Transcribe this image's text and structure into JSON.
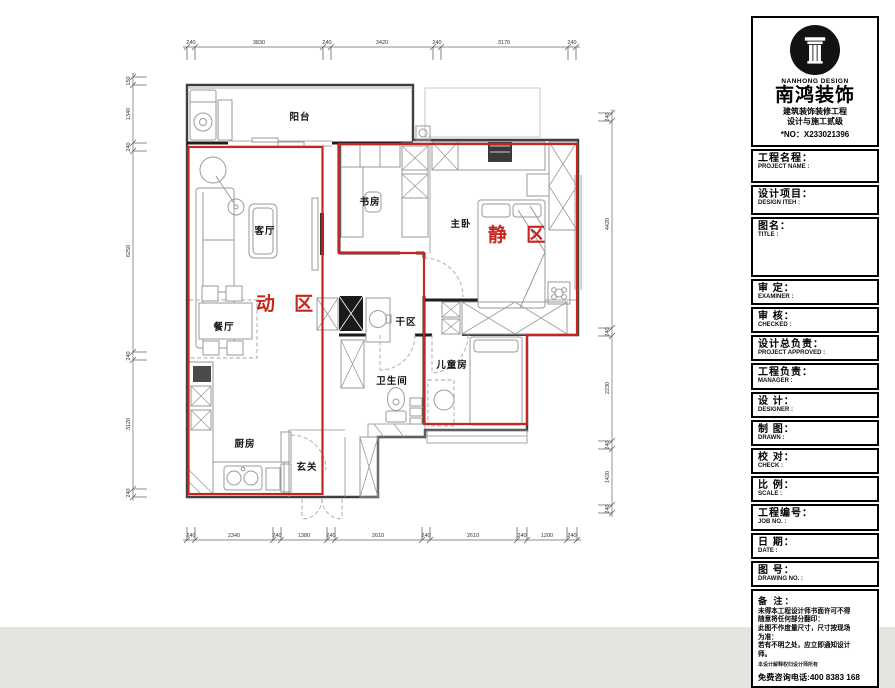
{
  "canvas": {
    "paper": "#ffffff",
    "outside": "#e4e4e1",
    "wall_line": "#3f3f3f",
    "accent_red": "#c5271e"
  },
  "plan": {
    "rooms": [
      {
        "label": "阳台"
      },
      {
        "label": "客厅"
      },
      {
        "label": "餐厅"
      },
      {
        "label": "厨房"
      },
      {
        "label": "玄关"
      },
      {
        "label": "书房"
      },
      {
        "label": "主卧"
      },
      {
        "label": "干区"
      },
      {
        "label": "卫生间"
      },
      {
        "label": "儿童房"
      }
    ],
    "zones": [
      {
        "label": "动 区",
        "color": "#c5271e"
      },
      {
        "label": "静 区",
        "color": "#c5271e"
      }
    ],
    "dims": {
      "top": [
        "240",
        "3830",
        "240",
        "3420",
        "240",
        "3170",
        "240"
      ],
      "left": [
        "150",
        "1340",
        "240",
        "6250",
        "240",
        "3120",
        "240"
      ],
      "right": [
        "240",
        "4420",
        "240",
        "2230",
        "240",
        "1420",
        "240"
      ],
      "bottom": [
        "240",
        "2340",
        "240",
        "1380",
        "240",
        "2610",
        "240",
        "2610",
        "240",
        "1200",
        "240"
      ]
    }
  },
  "titleblock": {
    "brand": {
      "name_en": "NANHONG DESIGN",
      "name_zh": "南鸿装饰",
      "cert_line1": "建筑装饰装修工程",
      "cert_line2": "设计与施工贰级",
      "license": "*NO：X233021396"
    },
    "fields": [
      {
        "zh": "工程名程：",
        "en": "PROJECT NAME :"
      },
      {
        "zh": "设计项目：",
        "en": "DESIGN ITEH :"
      },
      {
        "zh": "图名：",
        "en": "TITLE :"
      },
      {
        "zh": "审  定：",
        "en": "EXAMINER :"
      },
      {
        "zh": "审  核：",
        "en": "CHECKED :"
      },
      {
        "zh": "设计总负责：",
        "en": "PROJECT APPROVED :"
      },
      {
        "zh": "工程负责：",
        "en": "MANAGER :"
      },
      {
        "zh": "设  计：",
        "en": "DESIGNER :"
      },
      {
        "zh": "制  图：",
        "en": "DRAWN :"
      },
      {
        "zh": "校  对：",
        "en": "CHECK :"
      },
      {
        "zh": "比  例：",
        "en": "SCALE :"
      },
      {
        "zh": "工程编号：",
        "en": "JOB NO. :"
      },
      {
        "zh": "日  期：",
        "en": "DATE :"
      },
      {
        "zh": "图  号：",
        "en": "DRAWING NO. :"
      }
    ],
    "notes": {
      "title": "备 注：",
      "lines": [
        "未得本工程设计师书面许可不得",
        "随意将任何部分翻印：",
        "此图不作度量尺寸，尺寸按现场",
        "为准：",
        "若有不明之处，应立即通知设计",
        "师。"
      ],
      "fine_print": "本设计解释权归设计师所有",
      "hotline": "免费咨询电话:400 8383 168"
    }
  }
}
